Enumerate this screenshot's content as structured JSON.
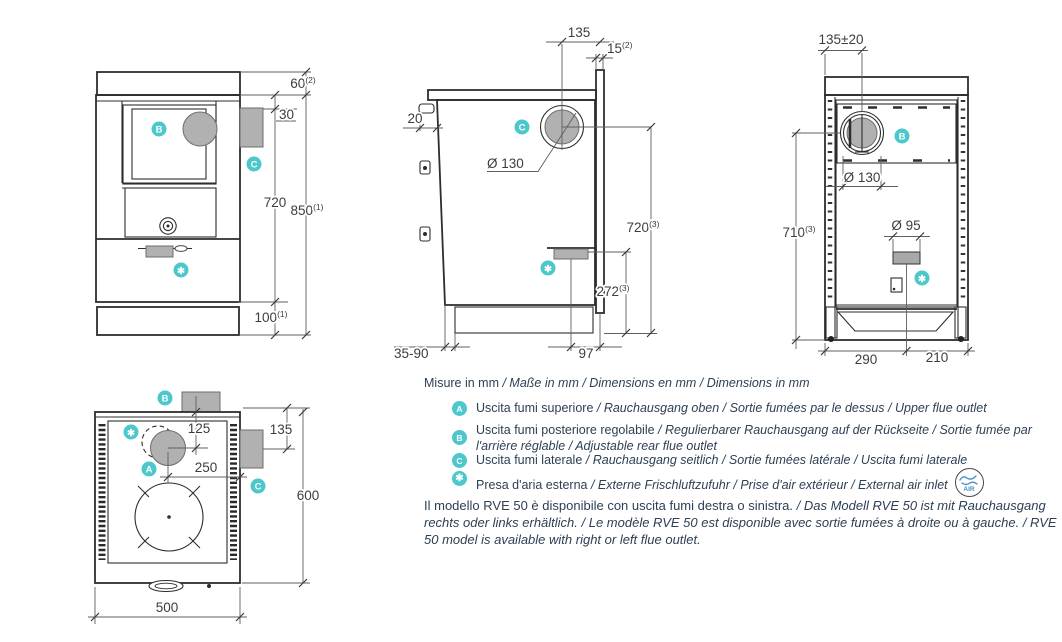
{
  "colors": {
    "accent": "#4cc7cb",
    "gray_fill": "#b1b1b1",
    "text": "#2e4054",
    "line": "#2d2d2d"
  },
  "markers": {
    "a": "A",
    "b": "B",
    "c": "C",
    "air": "✱"
  },
  "views": {
    "front": {
      "dim_60": {
        "v": "60",
        "s": "(2)"
      },
      "dim_30": "30",
      "dim_720": "720",
      "dim_850": {
        "v": "850",
        "s": "(1)"
      },
      "dim_100": {
        "v": "100",
        "s": "(1)"
      }
    },
    "side": {
      "dim_135": "135",
      "dim_15": {
        "v": "15",
        "s": "(2)"
      },
      "dim_20": "20",
      "dim_d130": "Ø 130",
      "dim_720": {
        "v": "720",
        "s": "(3)"
      },
      "dim_272": {
        "v": "272",
        "s": "(3)"
      },
      "dim_35_90": "35-90",
      "dim_97": "97"
    },
    "rear": {
      "dim_135_20": "135±20",
      "dim_d130": "Ø 130",
      "dim_d95": "Ø 95",
      "dim_710": {
        "v": "710",
        "s": "(3)"
      },
      "dim_290": "290",
      "dim_210": "210"
    },
    "top": {
      "dim_125": "125",
      "dim_135": "135",
      "dim_250": "250",
      "dim_600": "600",
      "dim_500": "500"
    }
  },
  "legend": {
    "units": {
      "primary": "Misure in mm",
      "translations": " / Maße in mm / Dimensions en mm / Dimensions in mm"
    },
    "items": [
      {
        "badge": "A",
        "primary": "Uscita fumi superiore",
        "translations": " / Rauchausgang oben  / Sortie fumées par le dessus / Upper flue outlet"
      },
      {
        "badge": "B",
        "primary": "Uscita fumi posteriore regolabile",
        "translations": " /  Regulierbarer Rauchausgang auf der Rückseite / Sortie fumée par l'arrière réglable / Adjustable rear flue outlet"
      },
      {
        "badge": "C",
        "primary": "Uscita fumi laterale",
        "translations": " / Rauchausgang seitlich  / Sortie fumées latérale / Uscita fumi laterale"
      },
      {
        "badge": "✱",
        "primary": "Presa d'aria esterna",
        "translations": " / Externe Frischluftzufuhr / Prise d'air extérieur / External air inlet"
      }
    ],
    "air_logo_text": "AIR"
  },
  "footer": {
    "primary": "Il modello RVE 50 è disponibile con uscita fumi destra o sinistra.",
    "translations": " / Das Modell RVE 50 ist mit Rauchausgang rechts oder links erhältlich. / Le modèle RVE 50 est disponible avec sortie fumées à droite ou à gauche. / RVE 50 model is available with right or left flue outlet."
  }
}
